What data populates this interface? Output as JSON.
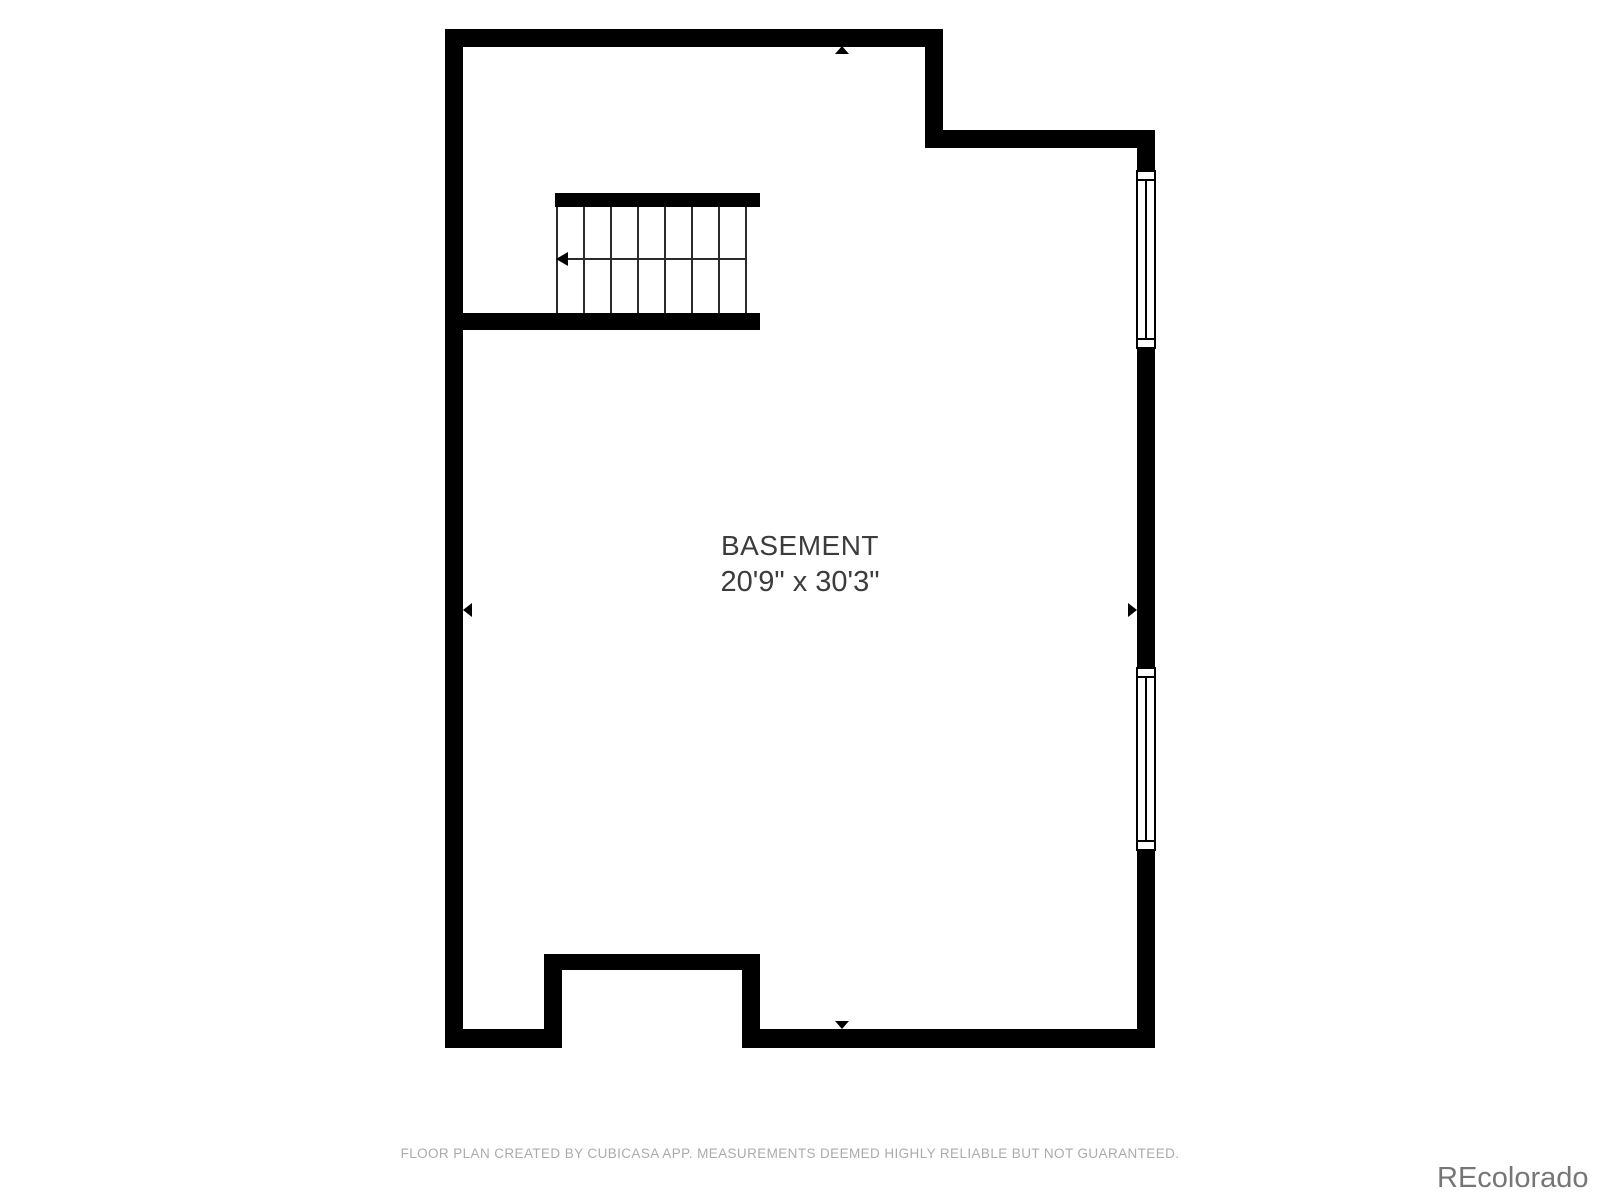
{
  "colors": {
    "wall": "#000000",
    "stair_line": "#2b2b2b",
    "room_text": "#3c3c3c",
    "footer_text": "#ababab",
    "watermark_text": "#767676",
    "background": "#ffffff"
  },
  "room": {
    "name": "BASEMENT",
    "dimensions": "20'9\" x 30'3\""
  },
  "stairs": {
    "step_count": 7,
    "direction": "left"
  },
  "windows": {
    "count": 2,
    "wall": "right"
  },
  "measurement_arrows": {
    "count": 4,
    "directions": [
      "up",
      "down",
      "left",
      "right"
    ]
  },
  "footer": {
    "disclaimer": "FLOOR PLAN CREATED BY CUBICASA APP. MEASUREMENTS DEEMED HIGHLY RELIABLE BUT NOT GUARANTEED."
  },
  "watermark": {
    "text": "REcolorado"
  }
}
